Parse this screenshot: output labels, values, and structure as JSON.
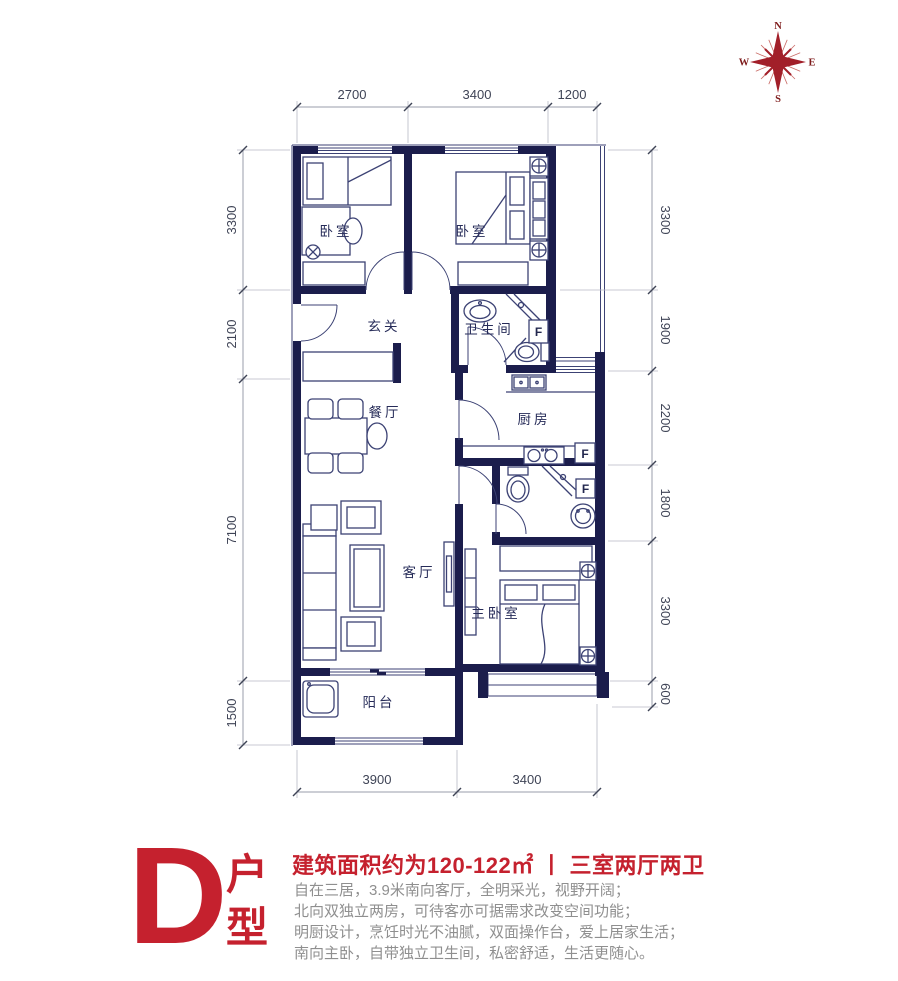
{
  "compass": {
    "n": "N",
    "e": "E",
    "s": "S",
    "w": "W"
  },
  "dimensions": {
    "top": [
      "2700",
      "3400",
      "1200"
    ],
    "bottom": [
      "3900",
      "3400"
    ],
    "left": [
      "3300",
      "2100",
      "7100",
      "1500"
    ],
    "right": [
      "3300",
      "1900",
      "2200",
      "1800",
      "3300",
      "600"
    ]
  },
  "rooms": {
    "bedroom_left": "卧室",
    "bedroom_right": "卧室",
    "bathroom_main": "卫生间",
    "entry": "玄关",
    "dining": "餐厅",
    "kitchen": "厨房",
    "living": "客厅",
    "master_bedroom": "主卧室",
    "balcony": "阳台",
    "flue": "F"
  },
  "info": {
    "unit_letter": "D",
    "unit_label_top": "户",
    "unit_label_bottom": "型",
    "headline": "建筑面积约为120-122㎡ 丨 三室两厅两卫",
    "description_lines": [
      "自在三居，3.9米南向客厅，全明采光，视野开阔；",
      "北向双独立两房，可待客亦可据需求改变空间功能；",
      "明厨设计，烹饪时光不油腻，双面操作台，爱上居家生活；",
      "南向主卧，自带独立卫生间，私密舒适，生活更随心。"
    ],
    "accent_color": "#c5212e"
  }
}
